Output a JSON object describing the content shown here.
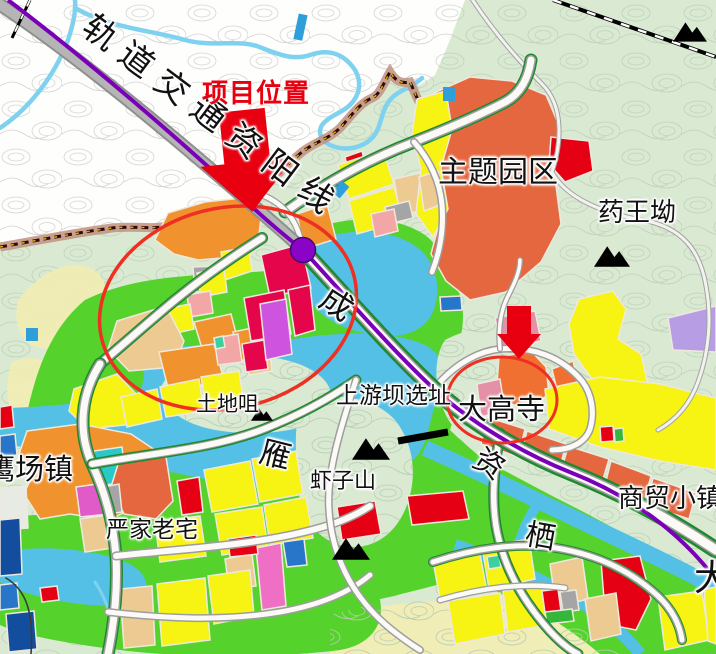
{
  "labels": {
    "rail_line": "轨道交通资阳线",
    "project_location": "项目位置",
    "theme_park": "主题园区",
    "yao_wang_ao": "药王坳",
    "cheng": "成",
    "upstream_dam_site": "上游坝选址",
    "da_gao_si": "大高寺",
    "tu_di_zui": "土地咀",
    "yan": "雁",
    "xia_zi_shan": "虾子山",
    "ying_chang_zhen": "鹰场镇",
    "yan_jia_lao_zhai": "严家老宅",
    "zi": "资",
    "trade_town": "商贸小镇",
    "qi": "栖",
    "da": "大"
  },
  "palette": {
    "background": "#d9e9d2",
    "outside_boundary": "#ffffff",
    "water": "#55c0e6",
    "greenspace": "#55d32c",
    "residential_yellow": "#f7f312",
    "commercial_crimson": "#e5054a",
    "mixed_orange": "#f0922d",
    "theme_park_vermilion": "#e4673f",
    "village_red": "#e60014",
    "entertainment_magenta": "#ce54df",
    "pink": "#f2a6a6",
    "rose_pink": "#ee6fc4",
    "tan": "#ecca92",
    "cyan": "#2ac9c9",
    "blue": "#2776ca",
    "dark_blue": "#134e9e",
    "light_purple": "#b79de4",
    "gray": "#a5a5a5",
    "metro_line": "#7a00b8",
    "metro_station": "#8a04c8",
    "highway_gray": "#9a9a9a",
    "road_green_edge": "#1e8a2e",
    "annotation_red": "#e80010",
    "boundary_dark_red": "#2e0b05",
    "boundary_band": "#c29080"
  }
}
